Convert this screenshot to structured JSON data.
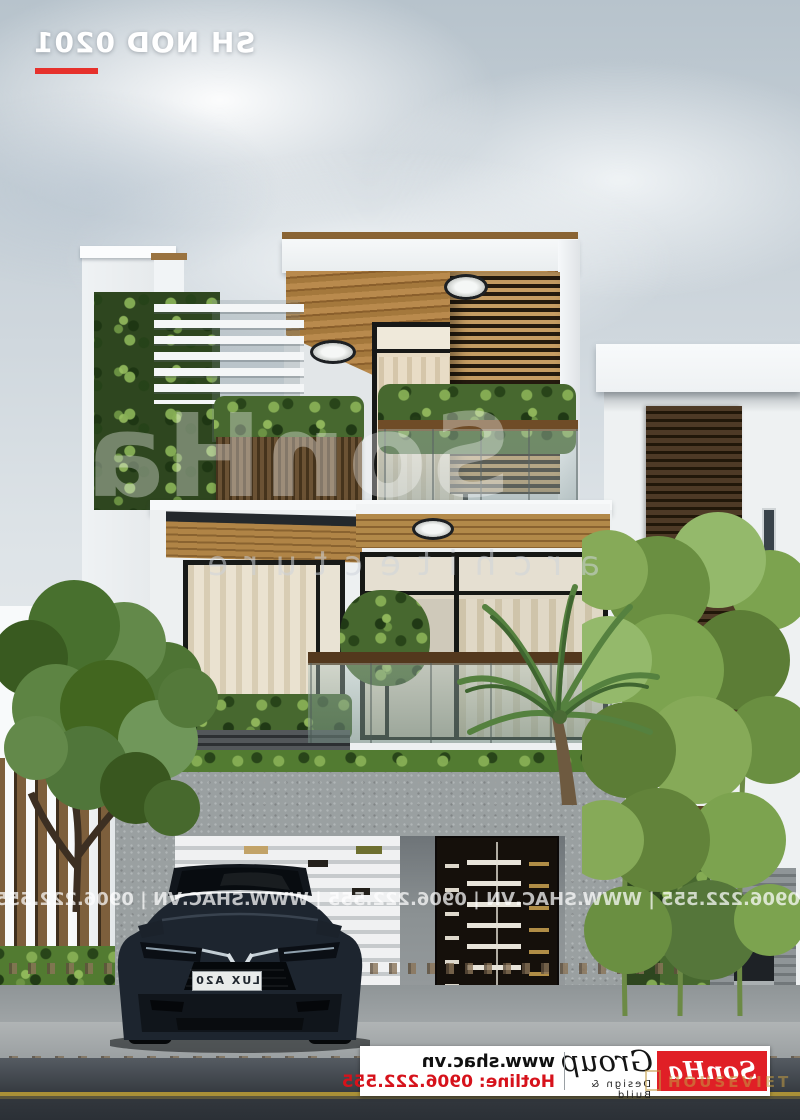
{
  "meta": {
    "project_code": "SH NOD 0201"
  },
  "watermarks": {
    "center_brand": "SonHa",
    "center_word": "architecture",
    "strip": "0906.222.555   |   WWW.SHAC.VN   |   0906.222.555   |   WWW.SHAC.VN   |   0906.222.555   |   WWW.SHAC.VN",
    "overlay_site": "HOUSEVIET"
  },
  "banner": {
    "website": "www.shac.vn",
    "hotline": "Hotline: 0906.222.555",
    "logo_name": "SonHa",
    "logo_group": "Group",
    "logo_tagline": "Design & Build"
  },
  "car": {
    "plate": "LUX A20"
  },
  "colors": {
    "accent_red": "#e6312c",
    "logo_red": "#e01f26",
    "watermark_gold": "#c39b41"
  }
}
